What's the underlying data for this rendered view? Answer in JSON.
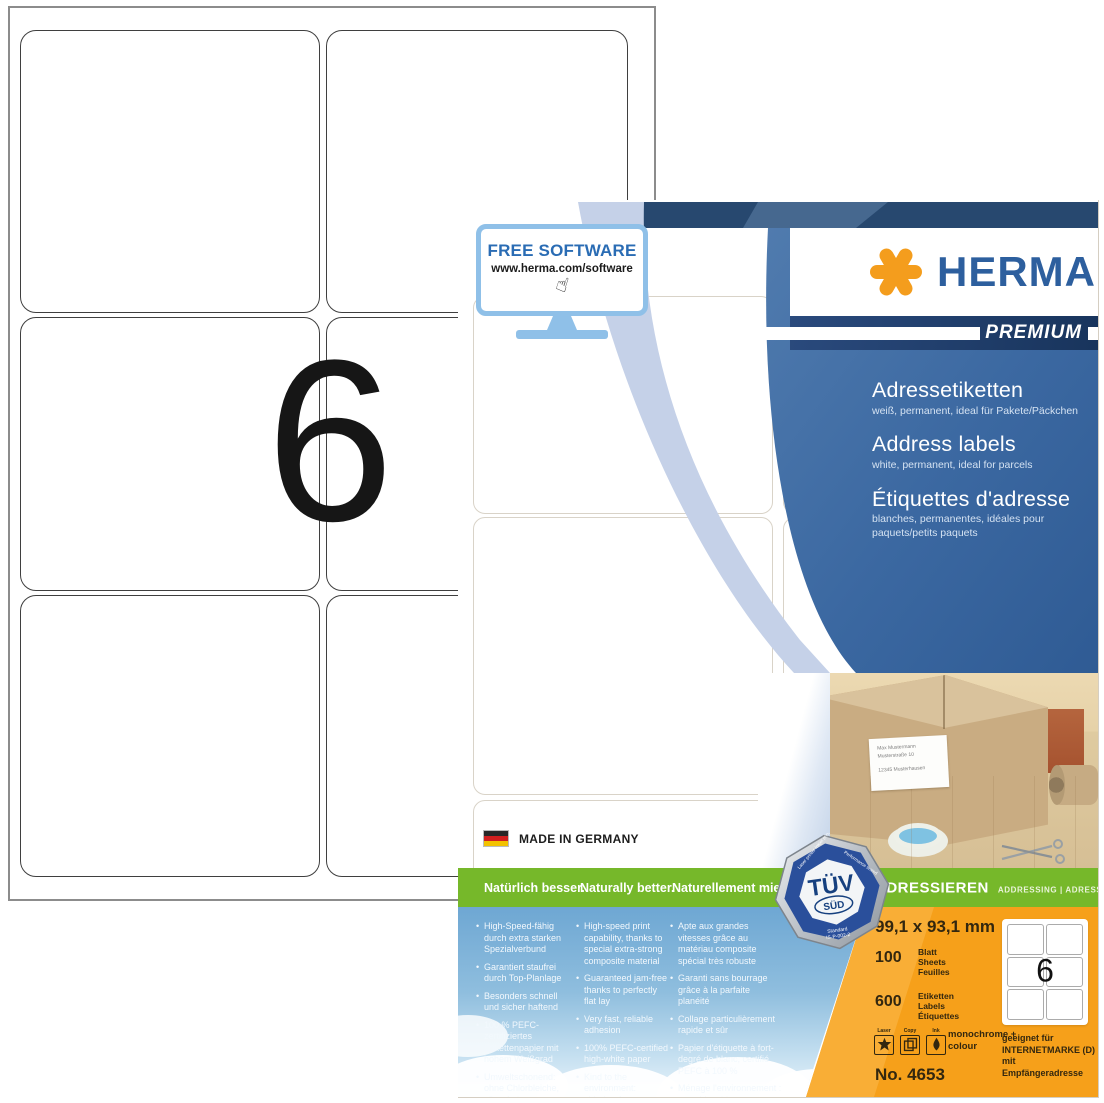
{
  "sheet": {
    "big_number": "6"
  },
  "box": {
    "free_software": {
      "title": "FREE SOFTWARE",
      "url": "www.herma.com/software",
      "cursor_icon": "hand-pointer"
    },
    "brand": {
      "name": "HERMA",
      "tier": "PREMIUM"
    },
    "product": {
      "de": {
        "title": "Adressetiketten",
        "subtitle": "weiß, permanent, ideal für Pakete/Päckchen"
      },
      "en": {
        "title": "Address labels",
        "subtitle": "white, permanent, ideal for parcels"
      },
      "fr": {
        "title": "Étiquettes d'adresse",
        "subtitle": "blanches, permanentes, idéales pour paquets/petits paquets"
      }
    },
    "made_in": "MADE IN GERMANY",
    "green_bar": {
      "de": "Natürlich besser.",
      "en": "Naturally better.",
      "fr": "Naturellement mieux."
    },
    "category_bar": {
      "title": "ADRESSIEREN",
      "subtitle": "ADDRESSING | ADRESSER"
    },
    "features": {
      "de": [
        "High-Speed-fähig durch extra starken Spezialverbund",
        "Garantiert staufrei durch Top-Planlage",
        "Besonders schnell und sicher haftend",
        "100 % PEFC-zertifiziertes Etikettenpapier mit hohem Weißgrad",
        "Umweltschonend: ohne Chlorbleiche, säurefrei, lösemittelfrei"
      ],
      "en": [
        "High-speed print capability, thanks to special extra-strong composite material",
        "Guaranteed jam-free thanks to perfectly flat lay",
        "Very fast, reliable adhesion",
        "100% PEFC-certified high-white paper",
        "Kind to the environment: chlorine-free bleached, acid and solvent-free"
      ],
      "fr": [
        "Apte aux grandes vitesses grâce au matériau composite spécial très robuste",
        "Garanti sans bourrage grâce à la parfaite planéité",
        "Collage particulièrement rapide et sûr",
        "Papier d'étiquette à fort-degré de blanc, certifié PEFC à 100 %",
        "Ménage l'environnement : sans blanchiment au chlore, ni acide, ni solvant"
      ]
    },
    "tuv": {
      "brand": "TÜV",
      "sub": "SÜD",
      "ring_left": "Laser printer Inkjet printer",
      "ring_right": "Performance tested",
      "standard_line1": "Standard",
      "standard_line2": "IS-P-002-2"
    },
    "photo_label": {
      "line1": "Max Mustermann",
      "line2": "Musterstraße 10",
      "line3": "12345 Musterhausen"
    },
    "specs": {
      "size": "99,1 x 93,1 mm",
      "sheets_count": "100",
      "sheets_units": [
        "Blatt",
        "Sheets",
        "Feuilles"
      ],
      "labels_count": "600",
      "labels_units": [
        "Etiketten",
        "Labels",
        "Étiquettes"
      ],
      "printer_icons": [
        "Laser",
        "Copy",
        "Ink"
      ],
      "print_modes": "monochrome + colour",
      "diagram_number": "6",
      "internetmarke": "geeignet für INTERNETMARKE (D) mit Empfängeradresse",
      "item_no": "No. 4653"
    },
    "colors": {
      "herma_blue": "#2d5f9e",
      "herma_orange": "#f49d1d",
      "premium_navy": "#1e3d68",
      "panel_blue": "#3f6da6",
      "green": "#76b82a",
      "sky_blue": "#7fb2d9",
      "orange_panel": "#f6a01a",
      "tuv_blue": "#2a4f9b"
    }
  }
}
